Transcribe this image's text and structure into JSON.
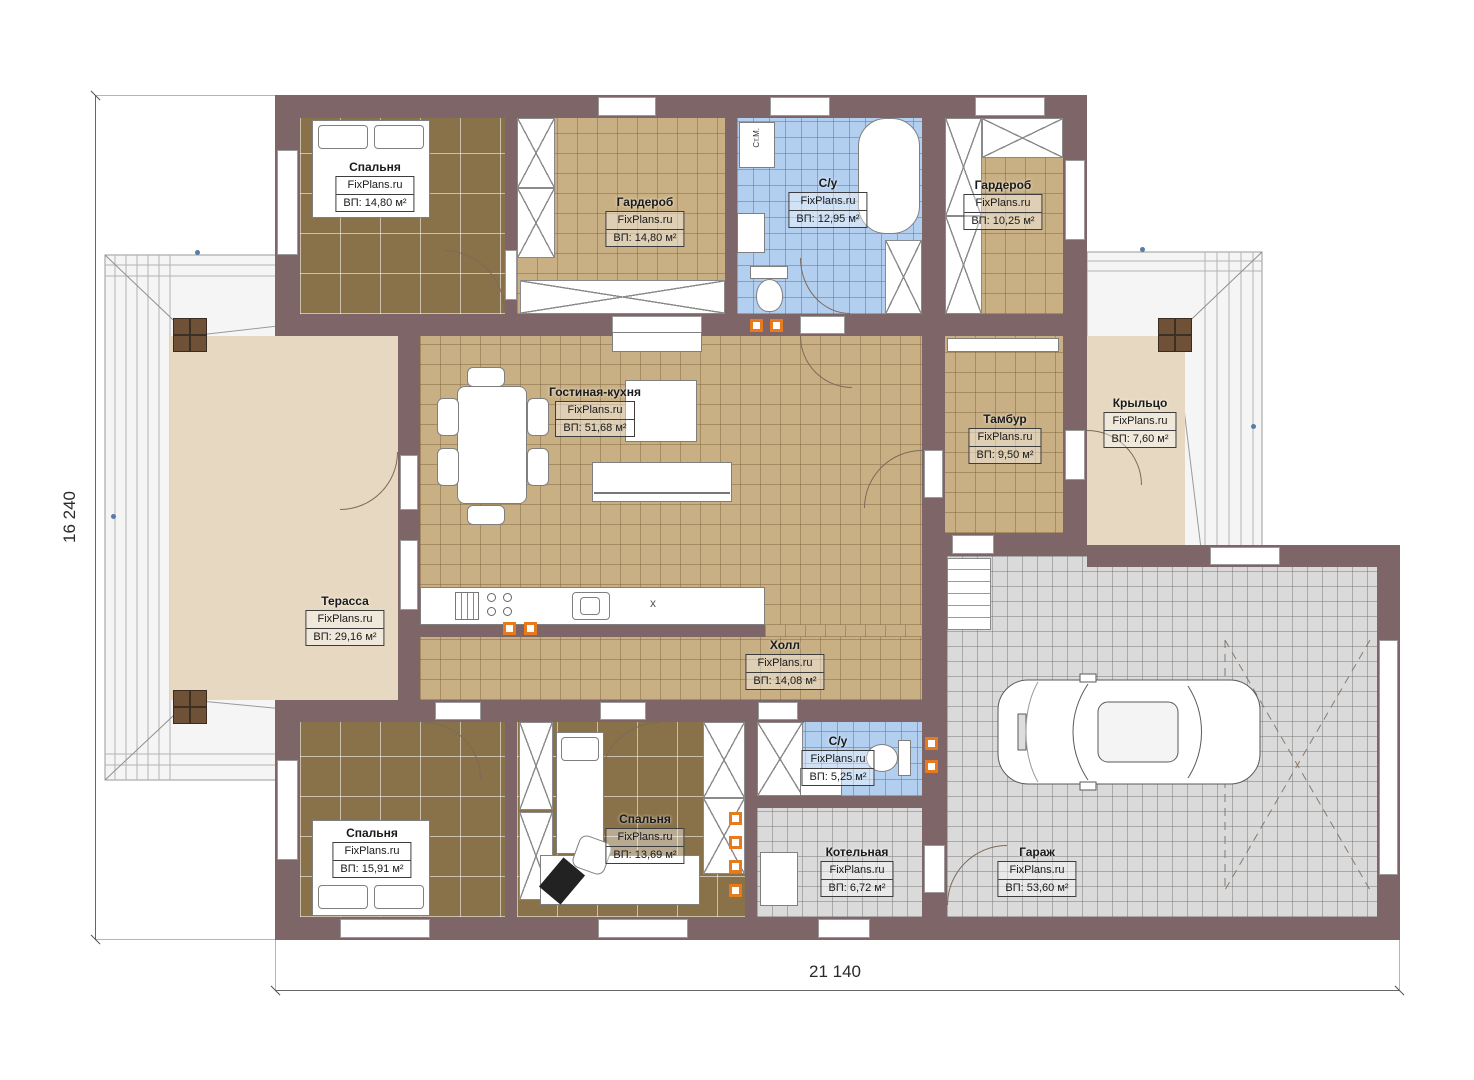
{
  "site_watermark": "FixPlans.ru",
  "dimensions": {
    "height_label": "16 240",
    "width_label": "21 140"
  },
  "annotations": {
    "washing_machine": "Ст.М.",
    "counter_mark": "x"
  },
  "colors": {
    "wall": "#7e6568",
    "floor_tan": "#c9b084",
    "floor_dark": "#897249",
    "floor_blue": "#b3cff0",
    "floor_gray": "#dadada",
    "floor_beige": "#e7d9c1",
    "marker_orange": "#e87a1e",
    "roof_dot_blue": "#5b7ca6"
  },
  "rooms": [
    {
      "id": "bedroom-1",
      "name": "Спальня",
      "site": "FixPlans.ru",
      "area": "ВП: 14,80 м²"
    },
    {
      "id": "wardrobe-1",
      "name": "Гардероб",
      "site": "FixPlans.ru",
      "area": "ВП: 14,80 м²"
    },
    {
      "id": "bathroom-1",
      "name": "С/у",
      "site": "FixPlans.ru",
      "area": "ВП: 12,95 м²"
    },
    {
      "id": "wardrobe-2",
      "name": "Гардероб",
      "site": "FixPlans.ru",
      "area": "ВП: 10,25 м²"
    },
    {
      "id": "living-kitchen",
      "name": "Гостиная-кухня",
      "site": "FixPlans.ru",
      "area": "ВП: 51,68 м²"
    },
    {
      "id": "tambour",
      "name": "Тамбур",
      "site": "FixPlans.ru",
      "area": "ВП: 9,50 м²"
    },
    {
      "id": "porch",
      "name": "Крыльцо",
      "site": "FixPlans.ru",
      "area": "ВП: 7,60 м²"
    },
    {
      "id": "terrace",
      "name": "Терасса",
      "site": "FixPlans.ru",
      "area": "ВП: 29,16 м²"
    },
    {
      "id": "hall",
      "name": "Холл",
      "site": "FixPlans.ru",
      "area": "ВП: 14,08 м²"
    },
    {
      "id": "bedroom-2",
      "name": "Спальня",
      "site": "FixPlans.ru",
      "area": "ВП: 15,91 м²"
    },
    {
      "id": "bedroom-3",
      "name": "Спальня",
      "site": "FixPlans.ru",
      "area": "ВП: 13,69 м²"
    },
    {
      "id": "bathroom-2",
      "name": "С/у",
      "site": "FixPlans.ru",
      "area": "ВП: 5,25 м²"
    },
    {
      "id": "boiler-room",
      "name": "Котельная",
      "site": "FixPlans.ru",
      "area": "ВП: 6,72 м²"
    },
    {
      "id": "garage",
      "name": "Гараж",
      "site": "FixPlans.ru",
      "area": "ВП: 53,60 м²"
    }
  ]
}
